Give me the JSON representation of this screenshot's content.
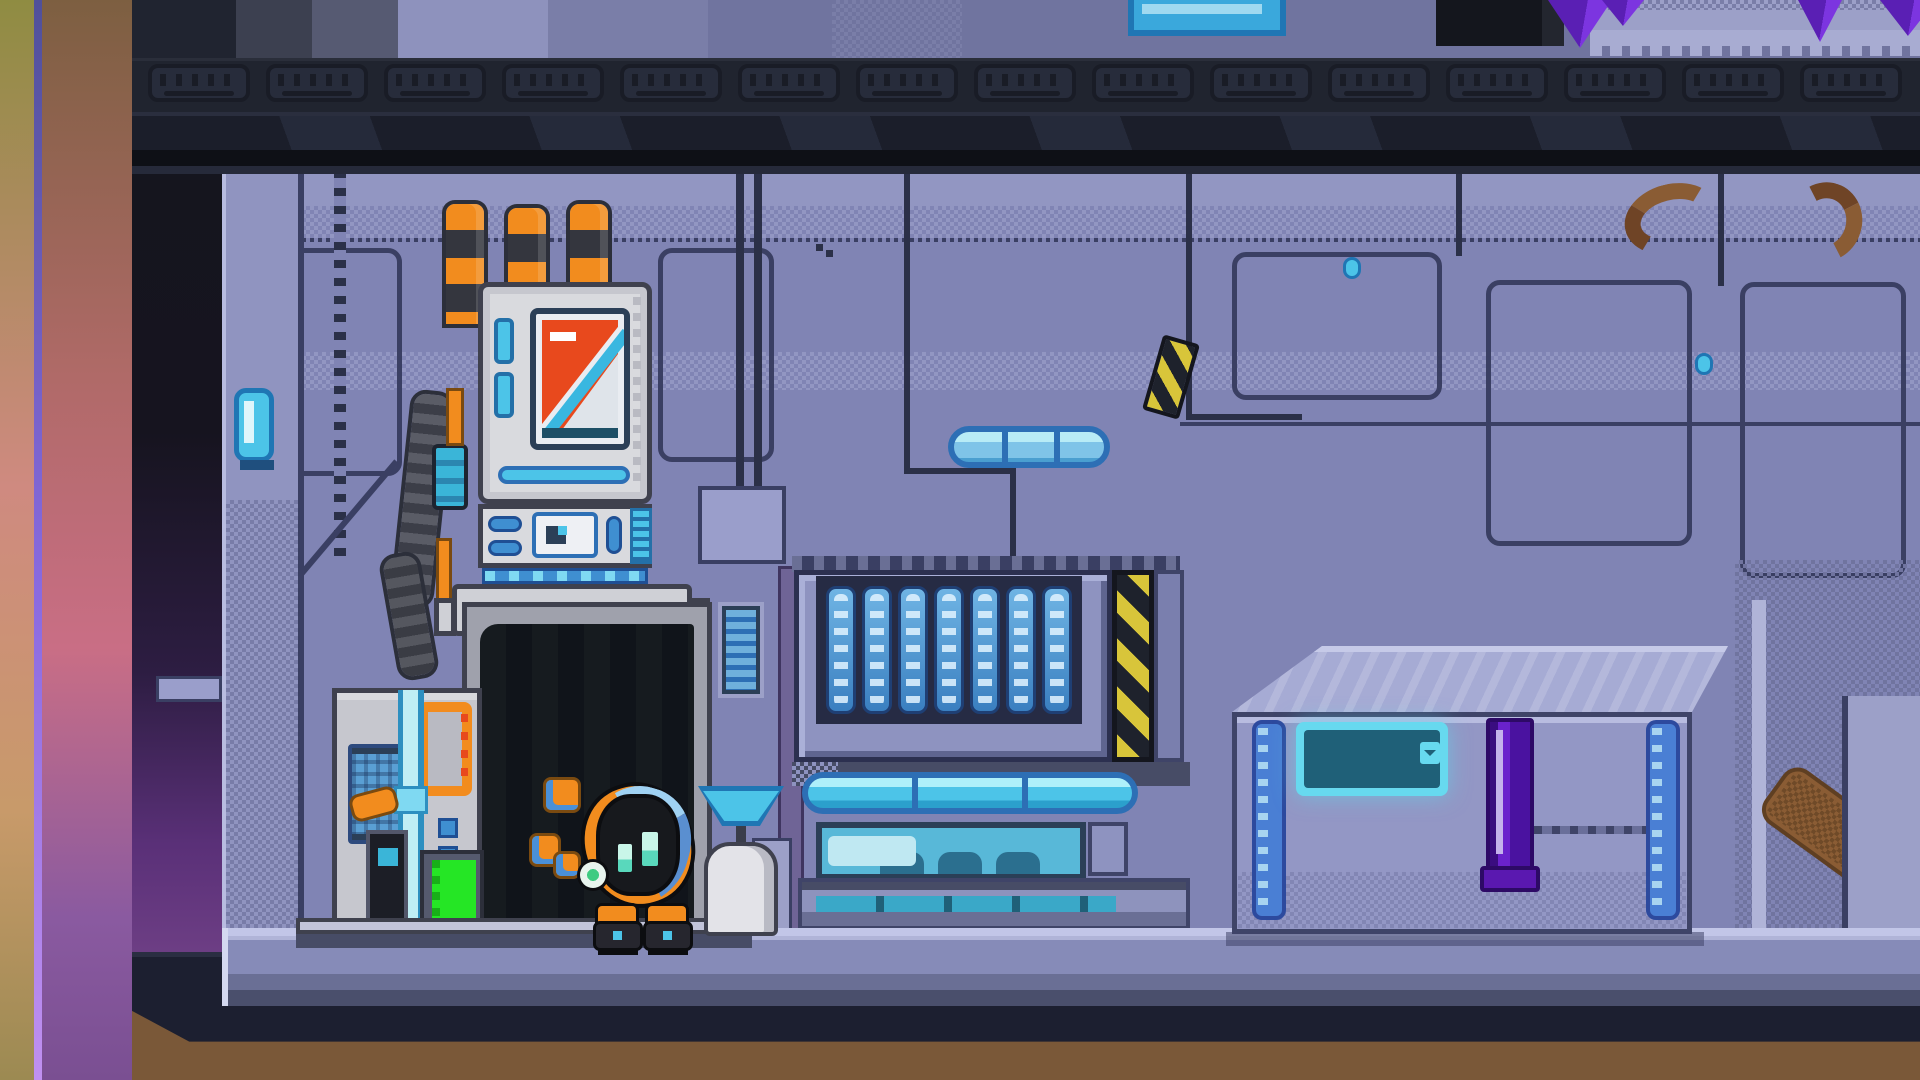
{
  "scene": {
    "description": "Pixel-art sci-fi station interior: striped-chimney reactor machine with open hatch, small round robot with orange ring, slatted vent console with hazard stripe, glowing-label cargo crate, upper floor with purple crystals",
    "upper_room": {
      "vent_modules": 15,
      "crystal_spikes": 4,
      "has_blue_crate": true,
      "has_dark_doorway": true,
      "gear_platform": true
    },
    "machine": {
      "chimney_count": 3,
      "chimney_stripes": "orange-black",
      "screen_sign": "orange warning triangle",
      "side_lights": 2,
      "indicator": "green bar",
      "hatch": "open dark doorway"
    },
    "robot": {
      "eye_count": 2,
      "debris_bits": 3,
      "ring_colors": "orange and blue",
      "badge": "white-green dot",
      "feet": 2
    },
    "dish_post": {
      "dish_color_name": "cyan"
    },
    "console": {
      "slat_columns": 7,
      "light_bar_segments": 3,
      "recess_humps": 3,
      "hazard_stripe": "yellow-black"
    },
    "crate": {
      "side_strips": 2,
      "label_lines": 3,
      "handle": "purple latch"
    },
    "wall": {
      "capsule_lamp": true,
      "bolt_count": 2,
      "hazard_mark": true,
      "hose_arcs": 2
    },
    "floor_bands": 3,
    "left_edge_strips": 2
  },
  "palette": {
    "wall": "#8084b4",
    "wallLight": "#9296c2",
    "wallLighter": "#a6aad4",
    "wallShade": "#70749f",
    "outline": "#3a3f63",
    "seamDark": "#2b3048",
    "beamDark": "#1b1e2a",
    "beamBlack": "#0e1016",
    "hullNavy": "#1c1f30",
    "ground": "#7a5838",
    "groundDark": "#5f4429",
    "machineWhite": "#d9dade",
    "machineGrey": "#9fa1ac",
    "outlineDark": "#3f414e",
    "orange": "#f28c1e",
    "stripeDark": "#34363e",
    "cyan": "#4cc4e8",
    "cyanPale": "#bfeef5",
    "cyanDeep": "#1f76b4",
    "blue": "#3f8fd1",
    "blueDark": "#2d6fb5",
    "navyScreen": "#2b3f57",
    "warnRed": "#e8491d",
    "green": "#25e625",
    "hazardYellow": "#d8c53a",
    "hazardBlack": "#1e222c",
    "crateFace": "#9397c5",
    "crateTop": "#a6abd4",
    "crateOutline": "#3f4468",
    "stripBlue": "#4a7fd4",
    "labelGlow": "#67d9ef",
    "labelInner": "#1f6078",
    "purple": "#6a22cc",
    "purpleDark": "#2d0a66",
    "crystal": "#7c35e0",
    "crystalDark": "#5a1fb4",
    "robotBody": "#17191d",
    "robotEye": "#c9f6e9",
    "robotEyeDeep": "#59d8bc",
    "badgeGreen": "#3ecb82",
    "doorBlack": "#12161a",
    "floorLight": "#c2c6e8",
    "floorMid": "#868bb8",
    "floorDark": "#4a4f6c",
    "gradOlive": "#8f8c42",
    "gradSalmon": "#cf8a80",
    "gradBrown": "#7d5f41",
    "gradPink": "#c96e85",
    "gradViolet": "#8a5aa0",
    "purpleLine": "#8a6ae0",
    "darkColTop": "#14161e",
    "darkColMid": "#2d1d42",
    "darkColBottom": "#6e3f85",
    "upperBlue": "#3aa8dc",
    "brownPipe": "#8a5c34",
    "dishCyan": "#4cc4e8",
    "pillarGrey": "#9ca0c8",
    "jambPurple": "#6f6496"
  }
}
